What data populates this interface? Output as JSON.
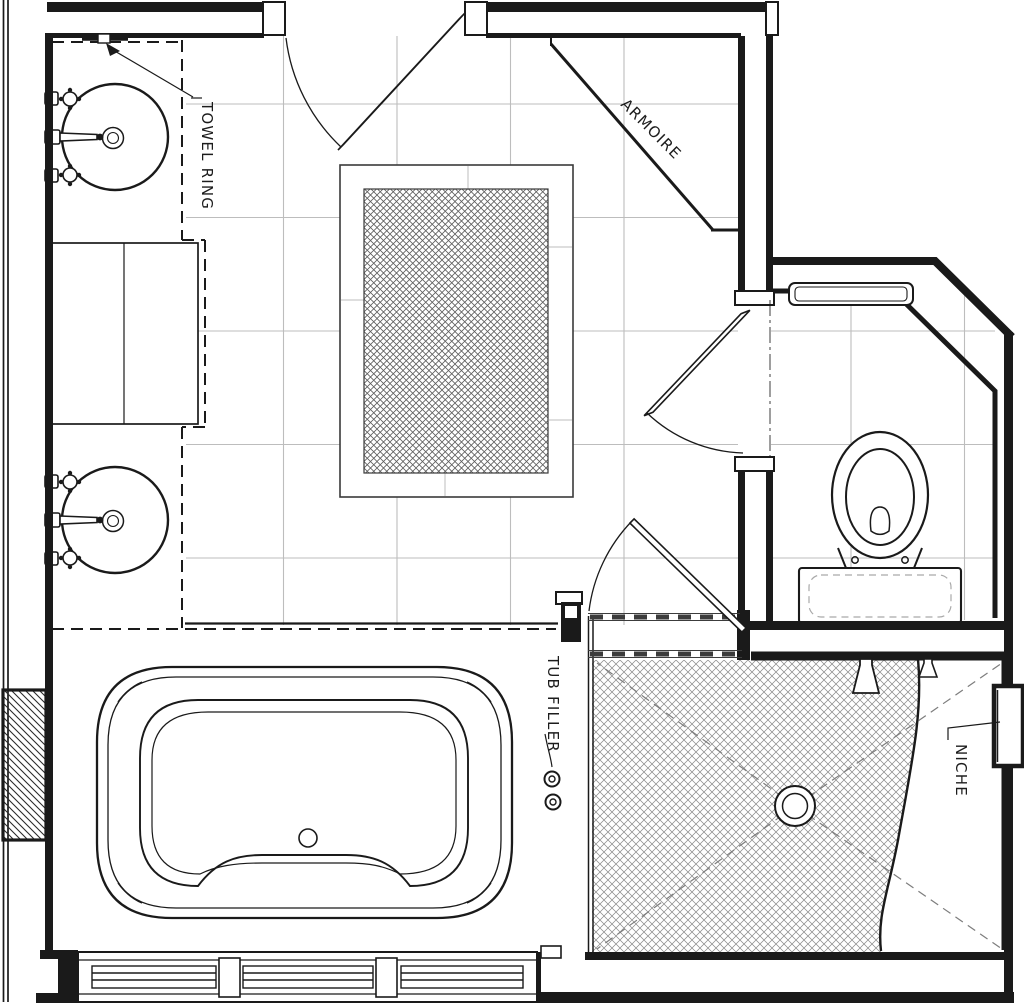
{
  "floor_plan": {
    "type": "bathroom-floor-plan",
    "background": "#ffffff",
    "line_color": "#1a1a1a",
    "tile_line_color": "#bdbdbd",
    "hatch_color": "#8a8a8a",
    "labels": {
      "towel_ring": "TOWEL RING",
      "armoire": "ARMOIRE",
      "tub_filler": "TUB FILLER",
      "niche": "NICHE"
    },
    "fixtures": [
      "vessel-sink-top",
      "vessel-sink-bottom",
      "linen-cabinet",
      "vanity-counter",
      "towel-ring",
      "entry-door",
      "corner-armoire",
      "area-rug",
      "toilet-room-door",
      "wall-shelf",
      "toilet",
      "shower-door",
      "shower-pan",
      "shower-drain",
      "shower-head-large",
      "shower-head-small",
      "wall-niche",
      "bathtub",
      "tub-filler-valves",
      "triple-window",
      "masonry-chase"
    ]
  }
}
